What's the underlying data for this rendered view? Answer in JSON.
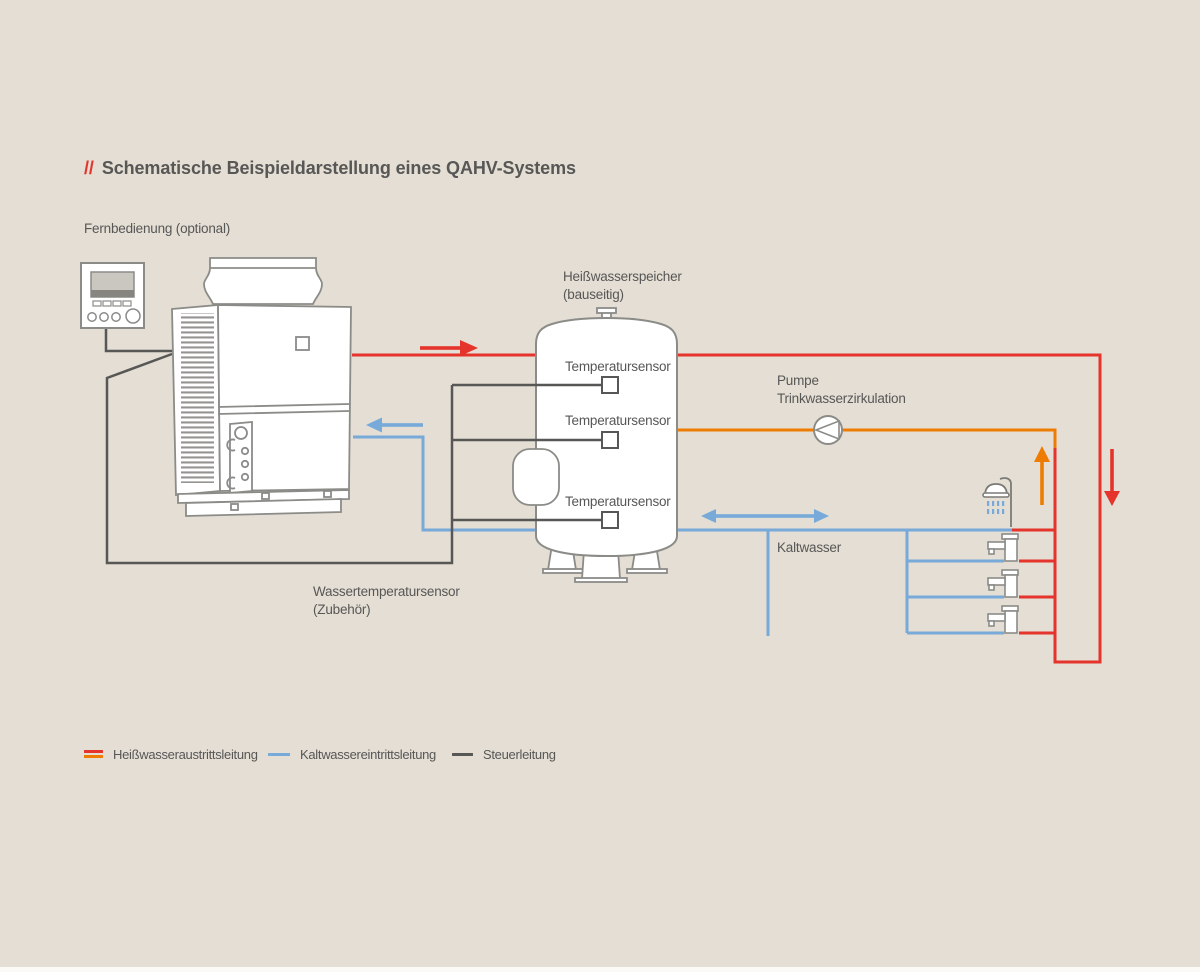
{
  "title": {
    "prefix": "//",
    "text": "Schematische Beispieldarstellung eines QAHV-Systems"
  },
  "labels": {
    "remote": "Fernbedienung (optional)",
    "tank_line1": "Heißwasserspeicher",
    "tank_line2": "(bauseitig)",
    "sensor1": "Temperatursensor",
    "sensor2": "Temperatursensor",
    "sensor3": "Temperatursensor",
    "pump_line1": "Pumpe",
    "pump_line2": "Trinkwasserzirkulation",
    "cold_water": "Kaltwasser",
    "water_sensor_line1": "Wassertemperatursensor",
    "water_sensor_line2": "(Zubehör)"
  },
  "legend": {
    "items": [
      {
        "label": "Heißwasseraustrittsleitung",
        "colors": [
          "#e5342b",
          "#ee7c03"
        ]
      },
      {
        "label": "Kaltwassereintrittsleitung",
        "colors": [
          "#77aad9"
        ]
      },
      {
        "label": "Steuerleitung",
        "colors": [
          "#575756"
        ]
      }
    ]
  },
  "icons": {
    "pump": "pump-circle-with-left-triangle",
    "shower": "shower-head-with-spray",
    "faucet": "water-tap",
    "remote": "remote-controller-with-display",
    "heat_pump": "qahv-outdoor-unit",
    "tank": "vertical-storage-cylinder"
  },
  "colors": {
    "background": "#e4ded4",
    "hot": "#e5342b",
    "circulation": "#ee7c03",
    "cold": "#77aad9",
    "control": "#575756",
    "outline": "#8b8b88",
    "text": "#575756"
  }
}
